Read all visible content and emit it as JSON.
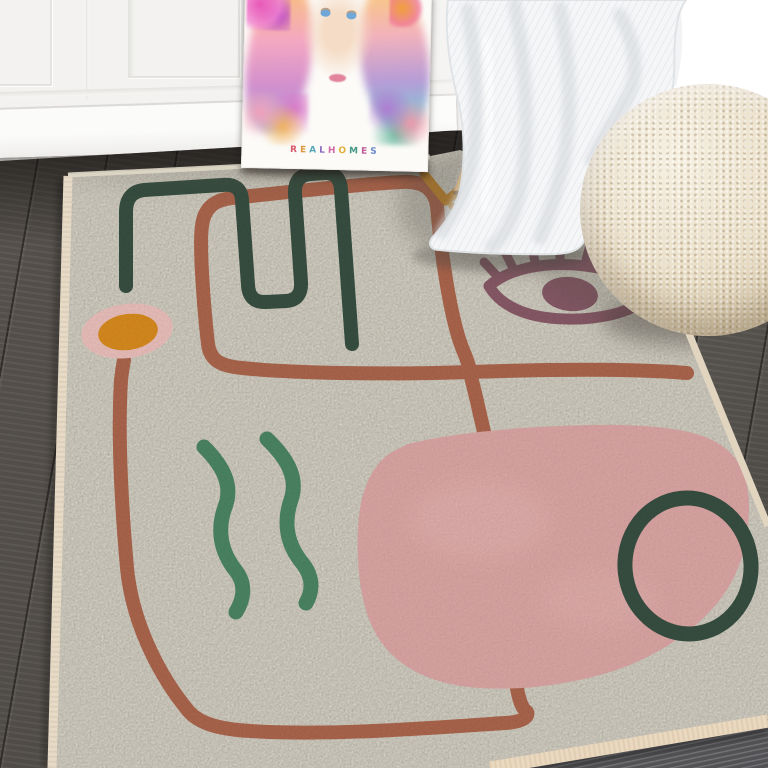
{
  "scene": {
    "type": "product-lifestyle-photo",
    "subject": "Abstract boho area rug in a room with poster, chair with knit throw and boucle pouf"
  },
  "poster": {
    "brand_text": "REALHOMES",
    "letter_colors": [
      "#d85a6a",
      "#e09a3c",
      "#58a8b8",
      "#8a6ac0",
      "#d06aa8",
      "#e0b03c",
      "#489888",
      "#c05a9a",
      "#6a88c8"
    ]
  },
  "palette": {
    "wall_white": "#f3f2f0",
    "floor_dark": "#514d48",
    "rug_cream": "#f0ebdd",
    "rug_edge": "#e7dbc8",
    "terracotta": "#b2694f",
    "dark_green": "#3a5244",
    "medium_green": "#4e8a67",
    "mauve": "#8d5d6b",
    "pink_blob": "#e3acaa",
    "ring_pink": "#f3c6c2",
    "orange": "#e0901f",
    "mustard": "#cd8a2e",
    "chair_wood": "#c79e66",
    "blanket_white": "#f5f6f8",
    "pouf_cream": "#ebe0ca"
  },
  "objects": {
    "rug_motifs": [
      "terracotta-meander-line",
      "dot-flower",
      "paperclip-line",
      "eye",
      "pink-blob",
      "circle-outline",
      "squiggles",
      "mustard-zigzag"
    ],
    "furniture": [
      "art-poster",
      "wooden-leg-chair",
      "knit-throw-blanket",
      "boucle-pouf"
    ]
  }
}
